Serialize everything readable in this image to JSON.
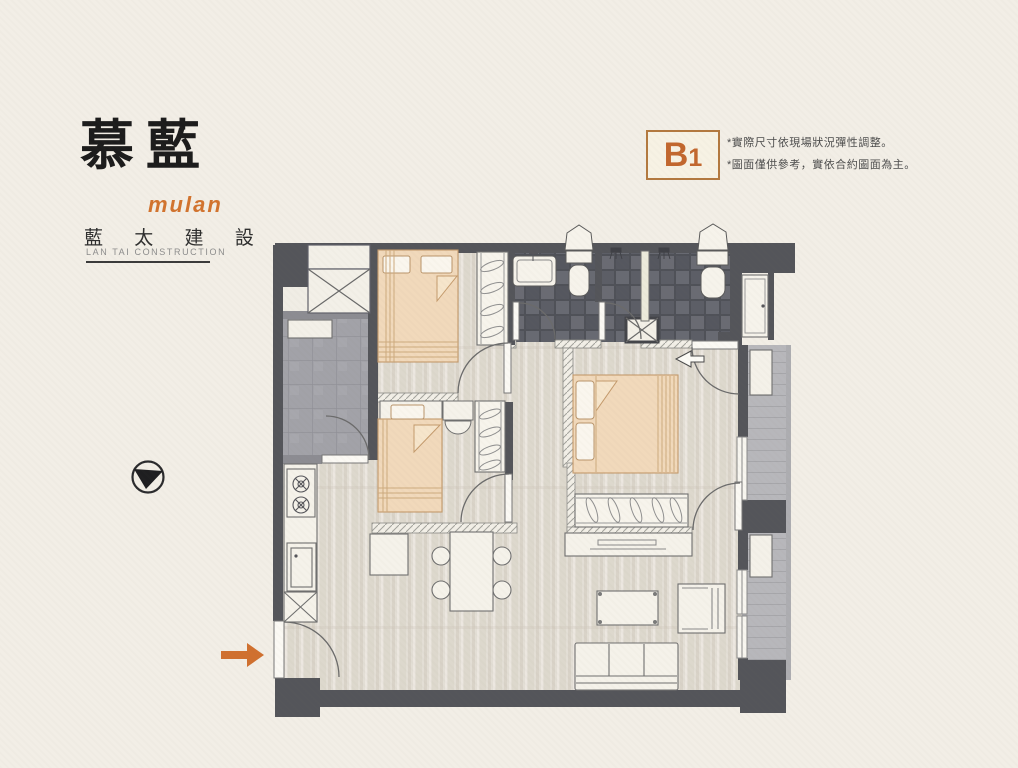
{
  "brand": {
    "logo_main": "慕藍",
    "logo_sub": "mulan",
    "company": "藍 太 建 設",
    "company_en": "LAN TAI CONSTRUCTION"
  },
  "unit_badge": {
    "letter": "B",
    "number": "1"
  },
  "notes": {
    "line1": "*實際尺寸依現場狀況彈性調整。",
    "line2": "*圖面僅供參考，實依合約圖面為主。"
  },
  "icons": {
    "compass": "north-compass-icon",
    "entry_arrow": "entry-direction-arrow",
    "balcony_arrow": "airflow-left-arrow"
  },
  "colors": {
    "background": "#f2eee6",
    "accent_orange": "#c2672e",
    "arrow_orange": "#d0702f",
    "badge_border": "#b3793f",
    "wall_dark": "#54555a",
    "wall_gray": "#8c8c92",
    "bathroom_tile": "#5f6167",
    "utility_floor": "#a2a2a8",
    "balcony_floor": "#b7b7bb",
    "floor_wood": "#e3ded5",
    "bed_fill": "#f1d9bb",
    "furniture_fill": "#f5f2ea"
  }
}
